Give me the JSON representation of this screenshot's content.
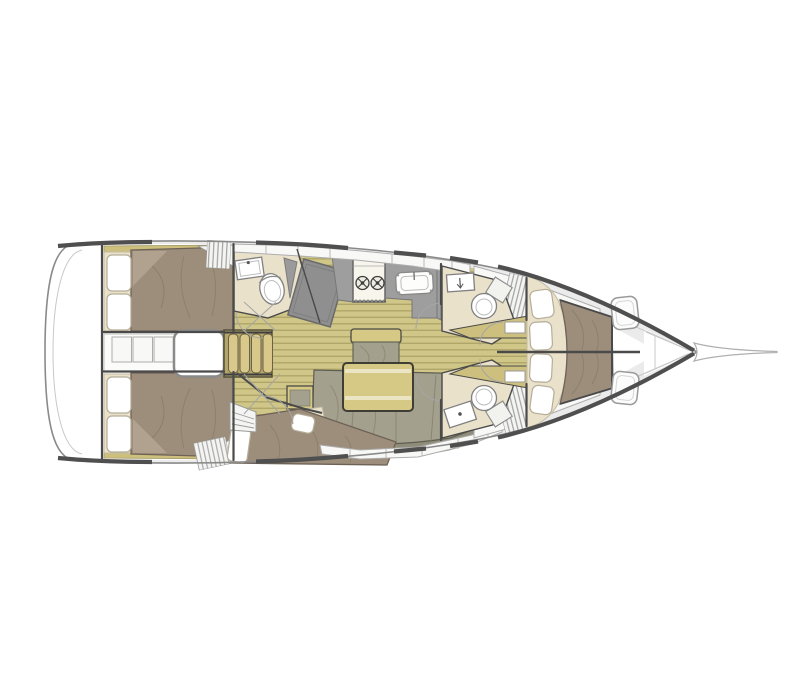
{
  "title": "Sailing yacht interior layout — top-down floor plan",
  "colors": {
    "deck": "#ebebeb",
    "hullLine": "#8a8a8a",
    "wall": "#4a4a4a",
    "wood": "#cfc687",
    "woodStripe": "#b1a66a",
    "shelf": "#cdc07e",
    "cream": "#eae1cb",
    "mattress": "#9c8e7b",
    "mattressLight": "#b0a28f",
    "pillow": "#ffffff",
    "counter": "#9e9e9e",
    "counterDark": "#8f8f8f",
    "sofa": "#a3a18e",
    "sofaDark": "#8f8d7a",
    "table": "#d6c985",
    "tableStripe": "#ece5c3",
    "stepsBase": "#b3a66a",
    "stepsTread": "#d8c88a",
    "hatch": "#fcfcfc",
    "white": "#ffffff"
  },
  "regions": [
    {
      "id": "transom",
      "label": "stern transom"
    },
    {
      "id": "aft-cabin-port",
      "label": "aft double cabin (top)"
    },
    {
      "id": "aft-cabin-starboard",
      "label": "aft double cabin (bottom)"
    },
    {
      "id": "engine-compartment",
      "label": "engine hatch between aft cabins"
    },
    {
      "id": "companionway-steps",
      "label": "companionway steps"
    },
    {
      "id": "aft-head",
      "label": "aft head with washbasin and WC"
    },
    {
      "id": "chart-table",
      "label": "angled chart table"
    },
    {
      "id": "galley",
      "label": "galley with two-burner stove and sink"
    },
    {
      "id": "saloon",
      "label": "saloon with U-sofa, folding table and bench"
    },
    {
      "id": "midship-berth",
      "label": "angled single berth cabin (bottom)"
    },
    {
      "id": "fwd-head-top",
      "label": "forward head (top) with WC and washbasin"
    },
    {
      "id": "fwd-head-bottom",
      "label": "forward head (bottom) with WC and washbasin"
    },
    {
      "id": "owner-cabin",
      "label": "forward owner cabin with island double berth"
    },
    {
      "id": "foredeck",
      "label": "foredeck with two deck hatches"
    },
    {
      "id": "bowsprit",
      "label": "bow point with bowsprit"
    }
  ]
}
